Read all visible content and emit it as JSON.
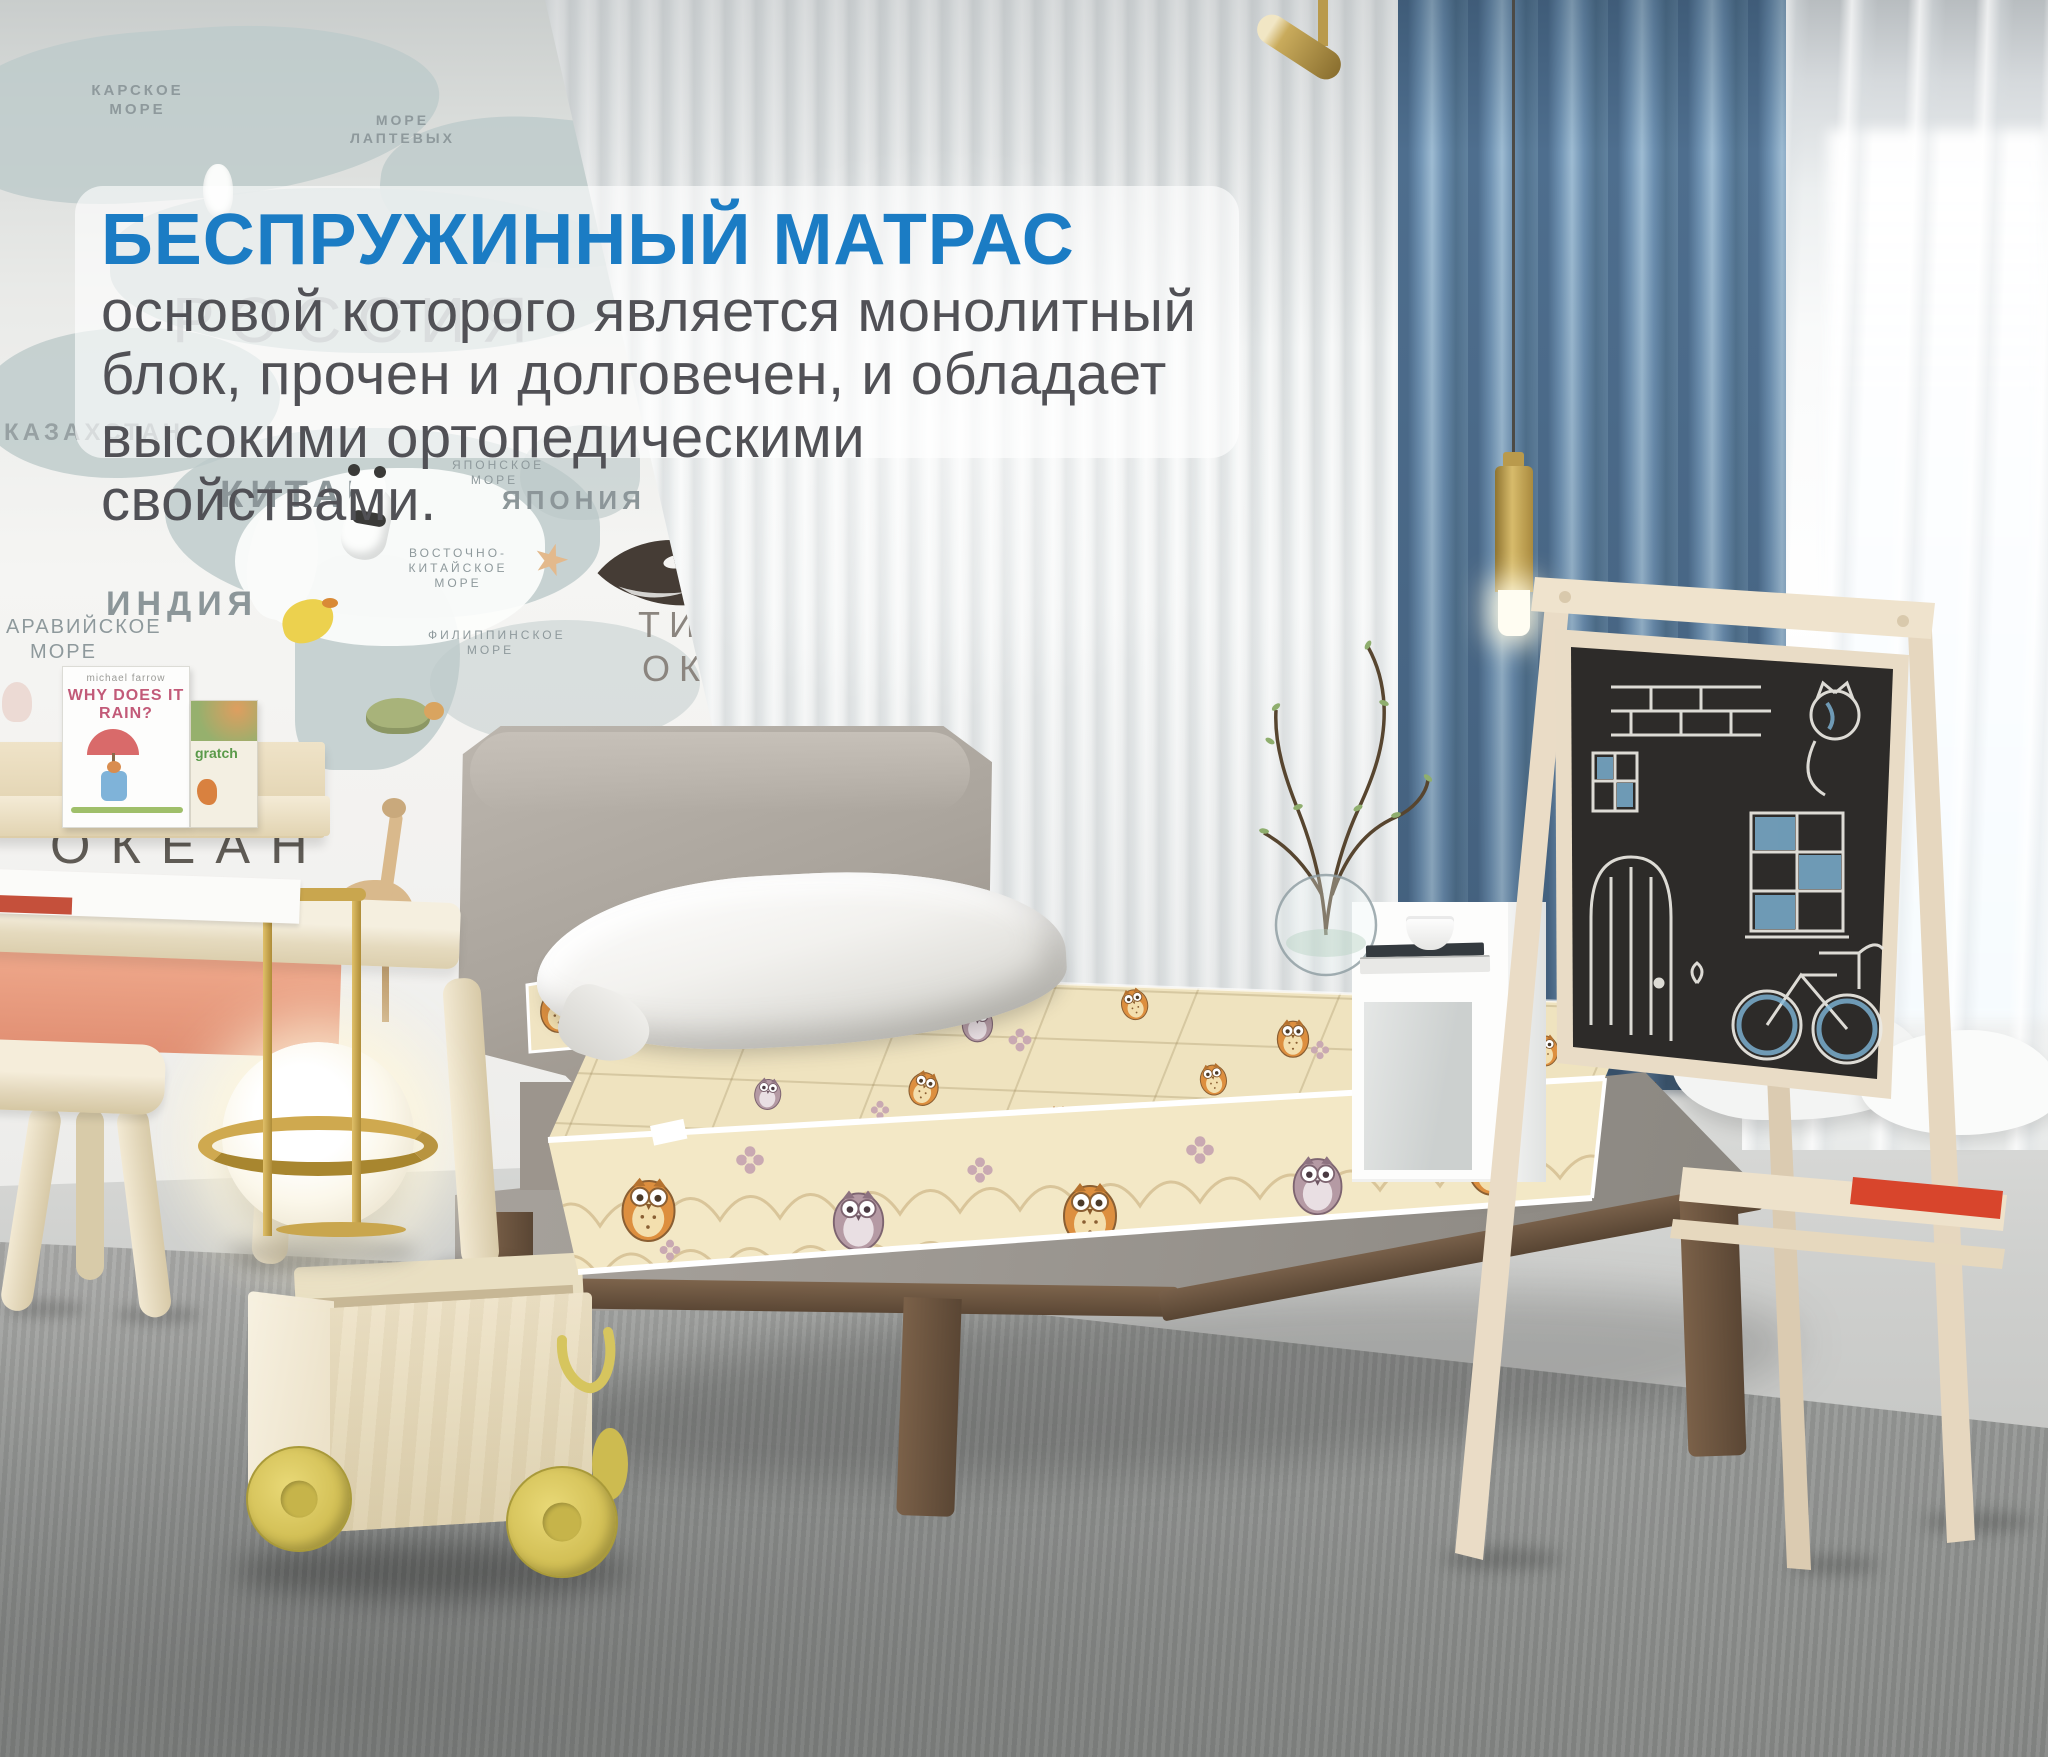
{
  "overlay": {
    "heading": "БЕСПРУЖИННЫЙ МАТРАС",
    "line1": "основой которого является монолитный",
    "line2": "блок, прочен и долговечен, и обладает",
    "line3": "высокими ортопедическими свойствами.",
    "heading_color": "#1b7cc4",
    "body_color": "#515156",
    "panel_color": "#ffffff"
  },
  "map_wall": {
    "labels": {
      "kara_sea": "КАРСКОЕ МОРЕ",
      "laptev_sea": "МОРЕ ЛАПТЕВЫХ",
      "russia": "РОССИЯ",
      "kazakhstan": "КАЗАХСТАН",
      "china": "КИТАЙ",
      "india": "ИНДИЯ",
      "japan": "ЯПОНИЯ",
      "japan_sea": "ЯПОНСКОЕ МОРЕ",
      "east_china_sea": "ВОСТОЧНО-КИТАЙСКОЕ МОРЕ",
      "philippine_sea": "ФИЛИППИНСКОЕ МОРЕ",
      "bering_sea": "БЕРИНГОВО МОРЕ",
      "arabian_sea": "АРАВИЙСКОЕ МОРЕ",
      "pacific_line1": "ТИХИЙ",
      "pacific_line2": "ОКЕАН",
      "indian_ocean": "ОКЕАН",
      "indian_ocean_partial": "инд",
      "australia": "АВСТРАЛИЯ"
    },
    "shelf_books": {
      "book1_author": "michael farrow",
      "book1_title": "WHY DOES IT RAIN?",
      "book2_title": "gratch"
    }
  },
  "scene": {
    "colors": {
      "curtain_blue": "#6d8fae",
      "mattress_cream": "#f0e4c2",
      "owl_orange": "#dd8f3f",
      "headboard_gray": "#aaa49c",
      "wood_leg_brown": "#6e563f",
      "light_wood": "#e9dfc8",
      "wheel_yellow": "#d9c75e",
      "brass": "#c9a64e",
      "floor_gray": "#d6d6d4",
      "carpet_gray": "#98999a",
      "chalkboard": "#2d2b29"
    }
  }
}
